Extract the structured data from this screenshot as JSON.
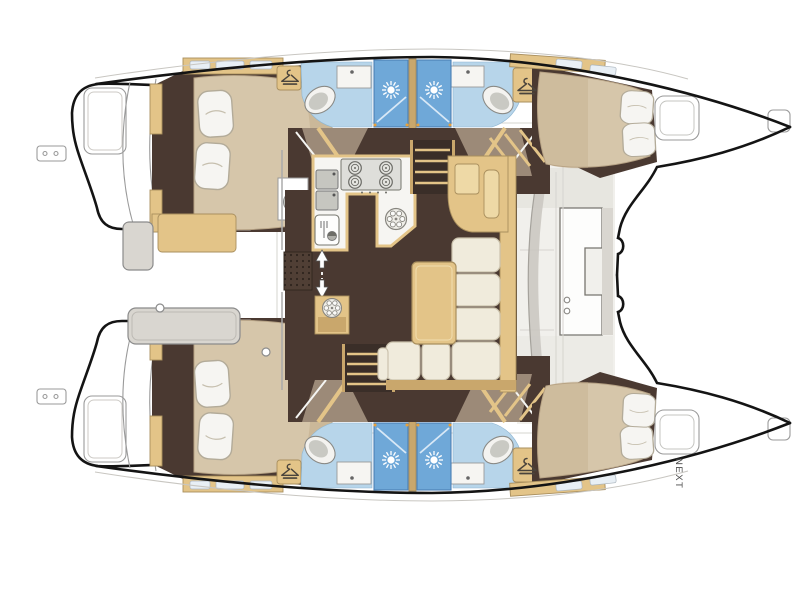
{
  "diagram": {
    "kind": "catamaran-interior-floor-plan",
    "orientation": "bows-to-the-right",
    "next_label": "NEXT",
    "counts": {
      "hulls": 2,
      "double_cabins": 4,
      "bathrooms": 4,
      "shower_stalls": 4,
      "toilets": 4,
      "wash_basins": 4,
      "wardrobes": 4,
      "companionway_stairs": 2,
      "galley_burners": 4,
      "galley_sinks": 2,
      "deck_hatches": 4
    },
    "features": [
      "l-shaped-saloon-sofa",
      "saloon-table",
      "chart-table",
      "u-shaped-galley",
      "entry-mat",
      "cockpit-benches",
      "swim-platform-steps",
      "bow-lockers"
    ]
  },
  "icons": {
    "wardrobe": "hanger-icon",
    "shower": "shower-head-icon",
    "toilet": "toilet-icon",
    "stove": "burner-icon",
    "vent": "spoke-wheel-icon",
    "companionway": "up-down-arrows-icon"
  },
  "palette": {
    "hull_outline": "#141414",
    "detail_line": "#9a9a9a",
    "floor_dark": "#4a3931",
    "floor_taupe": "#9c8a78",
    "wood_tan": "#e3c488",
    "wood_tan_light": "#eed9a6",
    "wood_tan_dark": "#c9a76c",
    "bed_beige": "#d6c6aa",
    "bed_shadow": "#bfa988",
    "pillow": "#ddd6c6",
    "cushion": "#f0ebdc",
    "bath_blue": "#b7d5ea",
    "shower_blue": "#6fa8d8",
    "fixture_white": "#f6f5f2",
    "fixture_gray": "#c6c6c0",
    "deck_gray": "#d9d6d0",
    "deck_light": "#efeeea",
    "accent_orange": "#e8a13c",
    "text_gray": "#4a4a4a"
  }
}
